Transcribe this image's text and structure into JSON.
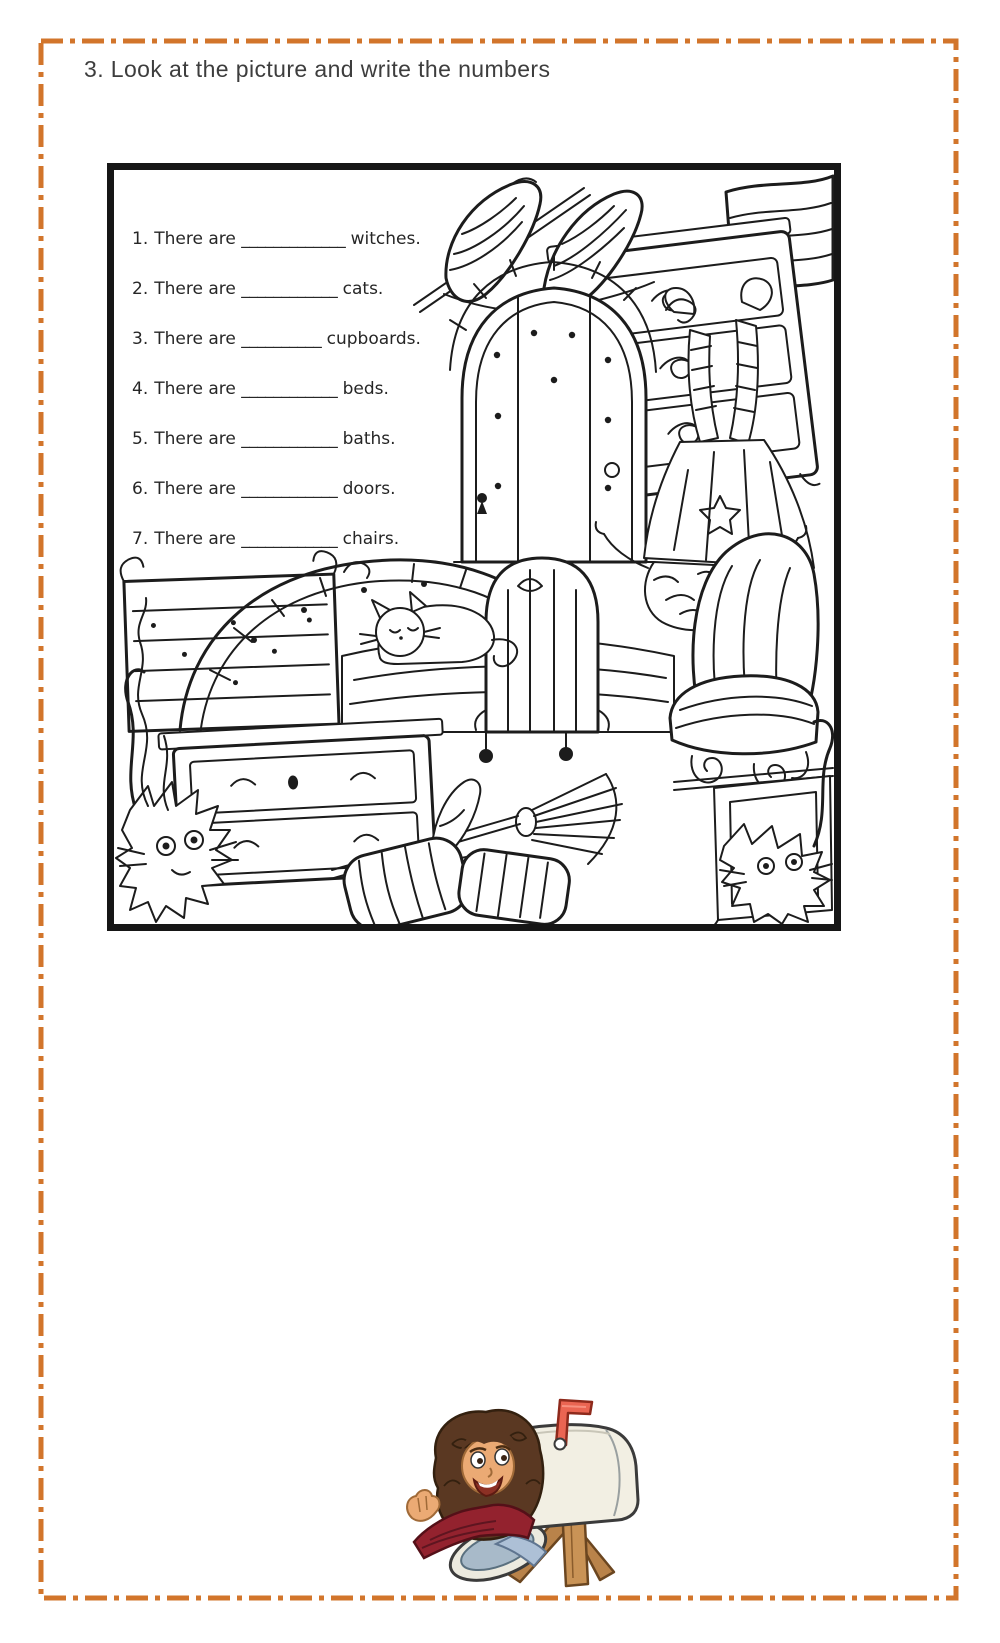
{
  "page": {
    "background": "#ffffff",
    "border_color": "#d2752b",
    "frame_color": "#161616",
    "text_color": "#262626"
  },
  "header": {
    "title": "3. Look at the picture and write the numbers"
  },
  "activity": {
    "sentences": [
      {
        "number": "1.",
        "text": "There are",
        "blank": "_____________",
        "noun": "witches."
      },
      {
        "number": "2.",
        "text": "There are",
        "blank": "____________",
        "noun": "cats."
      },
      {
        "number": "3.",
        "text": "There are",
        "blank": "__________",
        "noun": "cupboards."
      },
      {
        "number": "4.",
        "text": "There are",
        "blank": "____________",
        "noun": "beds."
      },
      {
        "number": "5.",
        "text": "There are",
        "blank": "____________",
        "noun": "baths."
      },
      {
        "number": "6.",
        "text": "There are",
        "blank": "____________",
        "noun": "doors."
      },
      {
        "number": "7.",
        "text": "There are",
        "blank": "____________",
        "noun": "chairs."
      }
    ],
    "picture_depicts": [
      "witch hats",
      "cupboard",
      "arched door",
      "upside-down witch",
      "beds",
      "sleeping cat",
      "armchair",
      "bath",
      "chest of drawers",
      "scruffy cats",
      "broom",
      "pillows"
    ]
  },
  "footer": {
    "sticker": "avatar-waving-from-mailbox",
    "colors": {
      "mailbox": "#f2efe3",
      "flag": "#ea6552",
      "hair": "#5a3822",
      "skin": "#ebaa74",
      "sweater": "#93222e",
      "jeans": "#adc0d6",
      "post": "#c99356",
      "door": "#a8bac9"
    }
  }
}
